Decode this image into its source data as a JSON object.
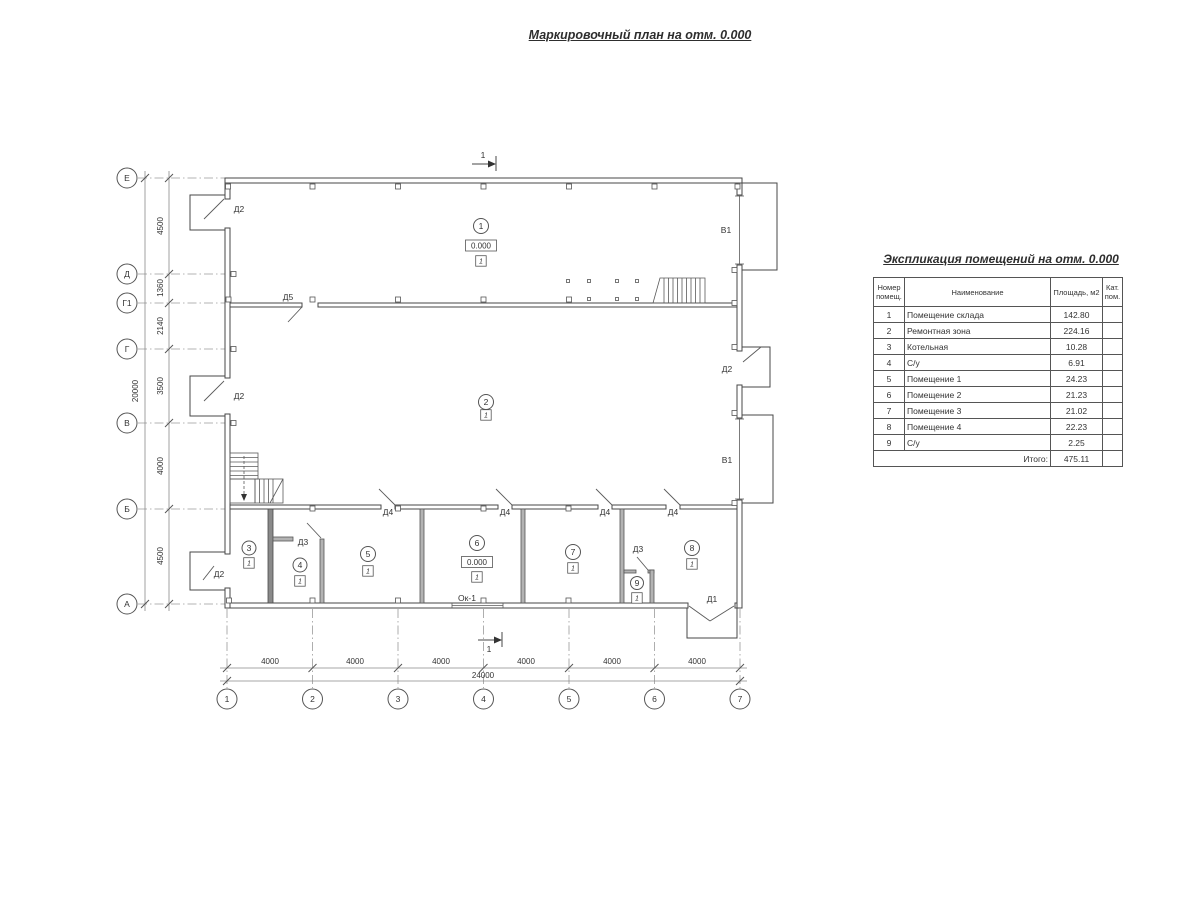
{
  "page": {
    "title": "Маркировочный план на отм. 0.000"
  },
  "plan": {
    "axis_left": [
      "Е",
      "Д",
      "Г1",
      "Г",
      "В",
      "Б",
      "А"
    ],
    "dims_left": [
      "4500",
      "1360",
      "2140",
      "3500",
      "4000",
      "4500"
    ],
    "total_left": "20000",
    "axis_bottom": [
      "1",
      "2",
      "3",
      "4",
      "5",
      "6",
      "7"
    ],
    "dims_bottom": [
      "4000",
      "4000",
      "4000",
      "4000",
      "4000",
      "4000"
    ],
    "total_bottom": "24000",
    "section_mark": "1",
    "rooms": [
      "1",
      "2",
      "3",
      "4",
      "5",
      "6",
      "7",
      "8",
      "9"
    ],
    "labels": {
      "d1": "Д1",
      "d2": "Д2",
      "d3": "Д3",
      "d4": "Д4",
      "d5": "Д5",
      "v1": "В1",
      "window": "Ок-1",
      "elevation": "0.000",
      "floor_type": "1"
    }
  },
  "table": {
    "title": "Экспликация помещений на отм. 0.000",
    "headers": {
      "num": "Номер помещ.",
      "name": "Наименование",
      "area": "Площадь, м2",
      "cat": "Кат. пом."
    },
    "rows": [
      {
        "num": "1",
        "name": "Помещение склада",
        "area": "142.80",
        "cat": ""
      },
      {
        "num": "2",
        "name": "Ремонтная зона",
        "area": "224.16",
        "cat": ""
      },
      {
        "num": "3",
        "name": "Котельная",
        "area": "10.28",
        "cat": ""
      },
      {
        "num": "4",
        "name": "С/у",
        "area": "6.91",
        "cat": ""
      },
      {
        "num": "5",
        "name": "Помещение 1",
        "area": "24.23",
        "cat": ""
      },
      {
        "num": "6",
        "name": "Помещение 2",
        "area": "21.23",
        "cat": ""
      },
      {
        "num": "7",
        "name": "Помещение 3",
        "area": "21.02",
        "cat": ""
      },
      {
        "num": "8",
        "name": "Помещение 4",
        "area": "22.23",
        "cat": ""
      },
      {
        "num": "9",
        "name": "С/у",
        "area": "2.25",
        "cat": ""
      }
    ],
    "total_label": "Итого:",
    "total_value": "475.11"
  }
}
